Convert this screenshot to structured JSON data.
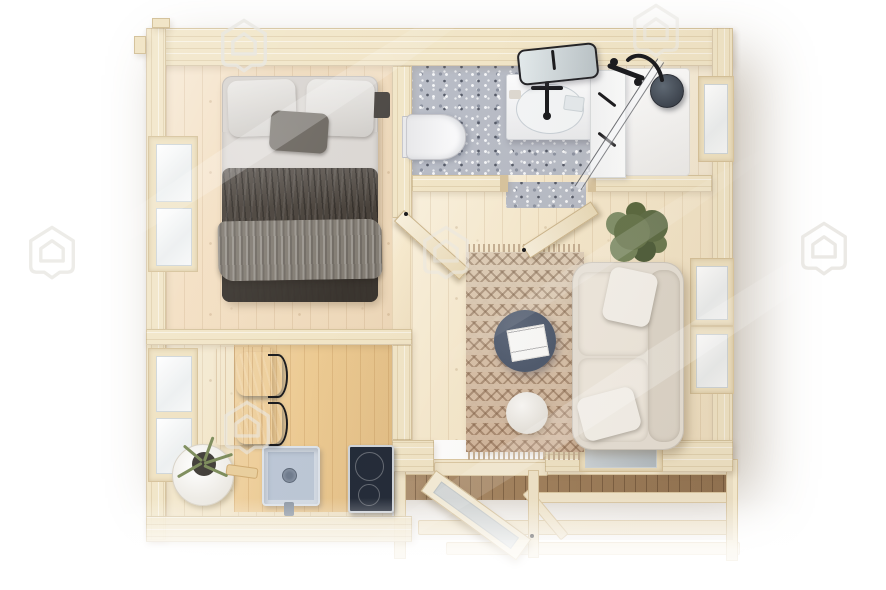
{
  "meta": {
    "type": "3d-floor-plan-render",
    "subject": "log cabin interior, top-down view",
    "canvas": {
      "width": 886,
      "height": 590
    }
  },
  "colors": {
    "background": "#ffffff",
    "wall_wood": "#f1e5c7",
    "wall_edge": "#d8c49e",
    "bedroom_floor": "#f3dfc2",
    "living_floor": "#f6e9cd",
    "bath_wood_floor": "#f8efdb",
    "kitchen_floor": "#f2e5c8",
    "honey_wood": "#ecca92",
    "table_wood": "#dfb275",
    "terrazzo": "#b8bcc6",
    "blanket_dark": "#474039",
    "throw_gray": "#837d74",
    "bedding_light": "#dbd7d3",
    "sofa_cream": "#e7e1d7",
    "pillow_white": "#f5f2ec",
    "rug_beige": "#d8c4aa",
    "rug_pattern": "#8a6a4c",
    "coffee_table_blue": "#4e5a6e",
    "pouf_white": "#f4f1ea",
    "chair_blue": "#6e8097",
    "plant_green": "#66754c",
    "hob_black": "#232b39",
    "fixture_black": "#1b1b1e",
    "sink_gray": "#bcc7d6",
    "shower_head_slate": "#4b5460",
    "deck_brown": "#a3835f",
    "porcelain_white": "#fbfbfc"
  },
  "scene": {
    "rooms": [
      {
        "name": "bedroom",
        "position": "top-left",
        "items": [
          "double-bed",
          "two-pillows",
          "gray-accent-pillow",
          "dark-blanket",
          "left-wall-window"
        ]
      },
      {
        "name": "bathroom",
        "position": "top-right",
        "items": [
          "wall-hung-toilet",
          "vanity-sink",
          "tilted-mirror",
          "black-faucet",
          "storage-cabinet",
          "walk-in-shower",
          "glass-screen",
          "shower-head",
          "terrazzo-floor",
          "right-wall-window"
        ]
      },
      {
        "name": "living-room",
        "position": "right",
        "items": [
          "cream-sofa",
          "white-cushions",
          "patterned-rug",
          "round-coffee-table",
          "open-magazine",
          "round-pouf",
          "potted-plant",
          "two-windows"
        ]
      },
      {
        "name": "kitchen-dining",
        "position": "bottom-left",
        "items": [
          "wood-dining-table",
          "two-blue-chairs",
          "inset-sink",
          "induction-hob",
          "potted-plant",
          "left-wall-window"
        ]
      },
      {
        "name": "entrance-deck",
        "position": "bottom",
        "items": [
          "open-glazed-door",
          "front-window",
          "wood-deck",
          "railings",
          "posts"
        ]
      }
    ],
    "watermark": {
      "shape": "house-logo-outline",
      "count": 6
    },
    "effects": [
      "diagonal-light-streaks",
      "bottom-white-fade",
      "warm-daylight"
    ]
  }
}
